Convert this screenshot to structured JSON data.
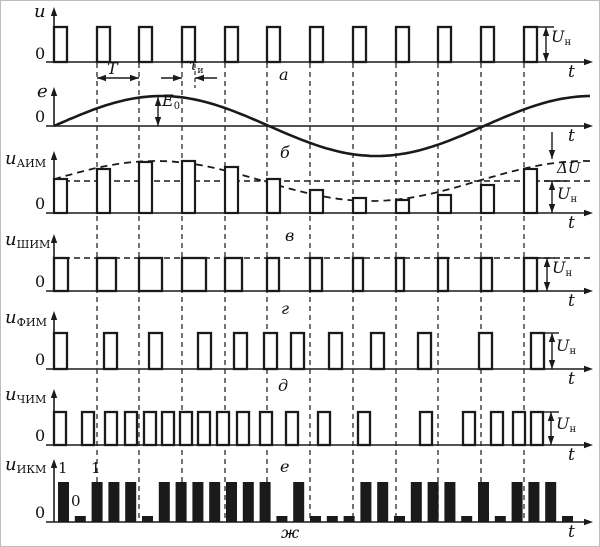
{
  "title": "Types of pulse modulation waveforms",
  "colors": {
    "ink": "#1a1a1a",
    "grid": "#3a3a3a",
    "bg": "#ffffff"
  },
  "layout": {
    "width": 600,
    "height": 547,
    "axis_x_start": 45,
    "axis_x_end": 592,
    "origin_x": 53,
    "grid_top": 62,
    "grid_bottom": 521
  },
  "gridlines_x": [
    96,
    138,
    181,
    224,
    266,
    309,
    352,
    395,
    437,
    480,
    523
  ],
  "sine": {
    "x0": 53,
    "period": 430
  },
  "rows": [
    {
      "id": "a",
      "type": "pulses",
      "baseline": 61,
      "axis_top": 6,
      "pulse_w": 13,
      "pulse_h": 35,
      "pulses_x": [
        53,
        96,
        138,
        181,
        224,
        266,
        309,
        352,
        395,
        437,
        480,
        523
      ],
      "un": {
        "tick": [
          536,
          553,
          26
        ],
        "arrow": [
          545,
          26,
          61
        ]
      }
    },
    {
      "id": "b",
      "type": "sine",
      "baseline": 125,
      "axis_top": 86,
      "amp": 30,
      "x_end": 592,
      "e0_arrow": [
        157,
        96,
        125
      ]
    },
    {
      "id": "v",
      "type": "aim",
      "baseline": 212,
      "axis_top": 150,
      "pulse_w": 13,
      "pulses_x": [
        53,
        96,
        138,
        181,
        224,
        266,
        309,
        352,
        395,
        437,
        480,
        523
      ],
      "pulse_h": [
        34,
        44,
        51,
        52,
        46,
        34,
        23,
        15,
        13,
        18,
        28,
        44
      ],
      "un_line_y": 180,
      "env": {
        "base": 32,
        "amp": 20,
        "x_off": 47
      },
      "down_arrow": [
        551,
        131,
        158
      ],
      "un_tick": [
        543,
        566,
        180
      ],
      "un_arrow": [
        551,
        180,
        212
      ]
    },
    {
      "id": "g",
      "type": "pwm",
      "baseline": 290,
      "axis_top": 233,
      "pulse_h": 33,
      "top_line_y": 257,
      "pulses": [
        [
          53,
          14
        ],
        [
          96,
          19
        ],
        [
          138,
          23
        ],
        [
          181,
          24
        ],
        [
          224,
          17
        ],
        [
          266,
          12
        ],
        [
          309,
          12
        ],
        [
          352,
          10
        ],
        [
          395,
          8
        ],
        [
          437,
          10
        ],
        [
          480,
          11
        ],
        [
          523,
          13
        ]
      ],
      "un": {
        "tick": [
          536,
          554,
          257
        ],
        "arrow": [
          546,
          257,
          290
        ]
      }
    },
    {
      "id": "d",
      "type": "pulses",
      "baseline": 368,
      "axis_top": 310,
      "pulse_w": 13,
      "pulse_h": 36,
      "pulses_x": [
        53,
        103,
        148,
        197,
        233,
        263,
        290,
        328,
        370,
        417,
        478,
        530
      ],
      "un": {
        "tick": [
          543,
          558,
          332
        ],
        "arrow": [
          551,
          332,
          368
        ]
      }
    },
    {
      "id": "e",
      "type": "pulses",
      "baseline": 444,
      "axis_top": 388,
      "pulse_w": 12,
      "pulse_h": 33,
      "pulses_x": [
        53,
        81,
        104,
        124,
        143,
        161,
        179,
        197,
        216,
        236,
        259,
        285,
        317,
        357,
        419,
        462,
        490,
        512,
        530
      ],
      "un": {
        "tick": [
          542,
          558,
          411
        ],
        "arrow": [
          550,
          411,
          444
        ]
      }
    },
    {
      "id": "zh",
      "type": "pcm",
      "baseline": 521,
      "axis_top": 458,
      "bar_w": 11,
      "tall_h": 40,
      "short_h": 6,
      "x_start": 57,
      "pitch": 16.8,
      "bits": [
        1,
        0,
        1,
        1,
        1,
        0,
        1,
        1,
        1,
        1,
        1,
        1,
        1,
        0,
        1,
        0,
        0,
        0,
        1,
        1,
        0,
        1,
        1,
        1,
        0,
        1,
        0,
        1,
        1,
        1,
        0
      ]
    }
  ],
  "annotations": {
    "T_arrow": {
      "x1": 96,
      "x2": 138,
      "y": 77
    },
    "tau_arrows": {
      "left": [
        160,
        181
      ],
      "right": [
        216,
        194
      ],
      "y": 77,
      "dash": [
        194,
        63,
        87
      ]
    }
  },
  "labels": [
    {
      "name": "axis-label-u",
      "text": "u",
      "x": 33,
      "y": 2,
      "size": 18,
      "it": 1
    },
    {
      "name": "axis-label-e",
      "text": "e",
      "x": 36,
      "y": 82,
      "size": 18,
      "it": 1
    },
    {
      "name": "axis-label-u-aim",
      "text": "u",
      "sub": "АИМ",
      "x": 4,
      "y": 149,
      "size": 18,
      "it": 1
    },
    {
      "name": "axis-label-u-shim",
      "text": "u",
      "sub": "ШИМ",
      "x": 4,
      "y": 230,
      "size": 18,
      "it": 1
    },
    {
      "name": "axis-label-u-fim",
      "text": "u",
      "sub": "ФИМ",
      "x": 4,
      "y": 308,
      "size": 18,
      "it": 1
    },
    {
      "name": "axis-label-u-chim",
      "text": "u",
      "sub": "ЧИМ",
      "x": 4,
      "y": 385,
      "size": 18,
      "it": 1
    },
    {
      "name": "axis-label-u-ikm",
      "text": "u",
      "sub": "ИКМ",
      "x": 4,
      "y": 455,
      "size": 18,
      "it": 1
    },
    {
      "name": "origin-zero-a",
      "text": "0",
      "x": 34,
      "y": 45,
      "size": 16
    },
    {
      "name": "origin-zero-b",
      "text": "0",
      "x": 34,
      "y": 108,
      "size": 16
    },
    {
      "name": "origin-zero-v",
      "text": "0",
      "x": 34,
      "y": 195,
      "size": 16
    },
    {
      "name": "origin-zero-g",
      "text": "0",
      "x": 34,
      "y": 273,
      "size": 16
    },
    {
      "name": "origin-zero-d",
      "text": "0",
      "x": 34,
      "y": 351,
      "size": 16
    },
    {
      "name": "origin-zero-e",
      "text": "0",
      "x": 34,
      "y": 427,
      "size": 16
    },
    {
      "name": "origin-zero-zh",
      "text": "0",
      "x": 34,
      "y": 504,
      "size": 16
    },
    {
      "name": "t-label-a",
      "text": "t",
      "x": 567,
      "y": 63,
      "size": 17,
      "it": 1
    },
    {
      "name": "t-label-b",
      "text": "t",
      "x": 567,
      "y": 127,
      "size": 17,
      "it": 1
    },
    {
      "name": "t-label-v",
      "text": "t",
      "x": 567,
      "y": 214,
      "size": 17,
      "it": 1
    },
    {
      "name": "t-label-g",
      "text": "t",
      "x": 567,
      "y": 292,
      "size": 17,
      "it": 1
    },
    {
      "name": "t-label-d",
      "text": "t",
      "x": 567,
      "y": 370,
      "size": 17,
      "it": 1
    },
    {
      "name": "t-label-e",
      "text": "t",
      "x": 567,
      "y": 446,
      "size": 17,
      "it": 1
    },
    {
      "name": "t-label-zh",
      "text": "t",
      "x": 567,
      "y": 523,
      "size": 17,
      "it": 1
    },
    {
      "name": "subplot-letter-a",
      "text": "а",
      "x": 278,
      "y": 66,
      "size": 16,
      "it": 1
    },
    {
      "name": "subplot-letter-b",
      "text": "б",
      "x": 279,
      "y": 144,
      "size": 16,
      "it": 1
    },
    {
      "name": "subplot-letter-v",
      "text": "в",
      "x": 284,
      "y": 227,
      "size": 16,
      "it": 1
    },
    {
      "name": "subplot-letter-g",
      "text": "г",
      "x": 280,
      "y": 300,
      "size": 16,
      "it": 1
    },
    {
      "name": "subplot-letter-d",
      "text": "д",
      "x": 277,
      "y": 377,
      "size": 16,
      "it": 1
    },
    {
      "name": "subplot-letter-e",
      "text": "е",
      "x": 279,
      "y": 458,
      "size": 16,
      "it": 1
    },
    {
      "name": "subplot-letter-zh",
      "text": "ж",
      "x": 280,
      "y": 524,
      "size": 16,
      "it": 1
    },
    {
      "name": "period-T-label",
      "text": "T",
      "x": 106,
      "y": 60,
      "size": 16,
      "it": 1
    },
    {
      "name": "tau-label",
      "text": "τ",
      "sub": "и",
      "x": 188,
      "y": 57,
      "size": 15,
      "it": 1
    },
    {
      "name": "E0-label",
      "text": "E",
      "sub": "0",
      "x": 161,
      "y": 92,
      "size": 16,
      "it": 1
    },
    {
      "name": "Un-label-a",
      "text": "U",
      "sub": "н",
      "x": 550,
      "y": 28,
      "size": 16,
      "it": 1
    },
    {
      "name": "dU-label-v",
      "text": "ΔU",
      "x": 556,
      "y": 160,
      "size": 15,
      "it": 1
    },
    {
      "name": "Un-label-v",
      "text": "U",
      "sub": "н",
      "x": 556,
      "y": 185,
      "size": 16,
      "it": 1
    },
    {
      "name": "Un-label-g",
      "text": "U",
      "sub": "н",
      "x": 551,
      "y": 259,
      "size": 16,
      "it": 1
    },
    {
      "name": "Un-label-d",
      "text": "U",
      "sub": "н",
      "x": 555,
      "y": 337,
      "size": 16,
      "it": 1
    },
    {
      "name": "Un-label-e",
      "text": "U",
      "sub": "н",
      "x": 555,
      "y": 415,
      "size": 16,
      "it": 1
    },
    {
      "name": "bit-label-one-1",
      "text": "1",
      "x": 57,
      "y": 460,
      "size": 15
    },
    {
      "name": "bit-label-zero",
      "text": "0",
      "x": 70,
      "y": 493,
      "size": 15
    },
    {
      "name": "bit-label-one-2",
      "text": "1",
      "x": 90,
      "y": 460,
      "size": 15
    }
  ]
}
